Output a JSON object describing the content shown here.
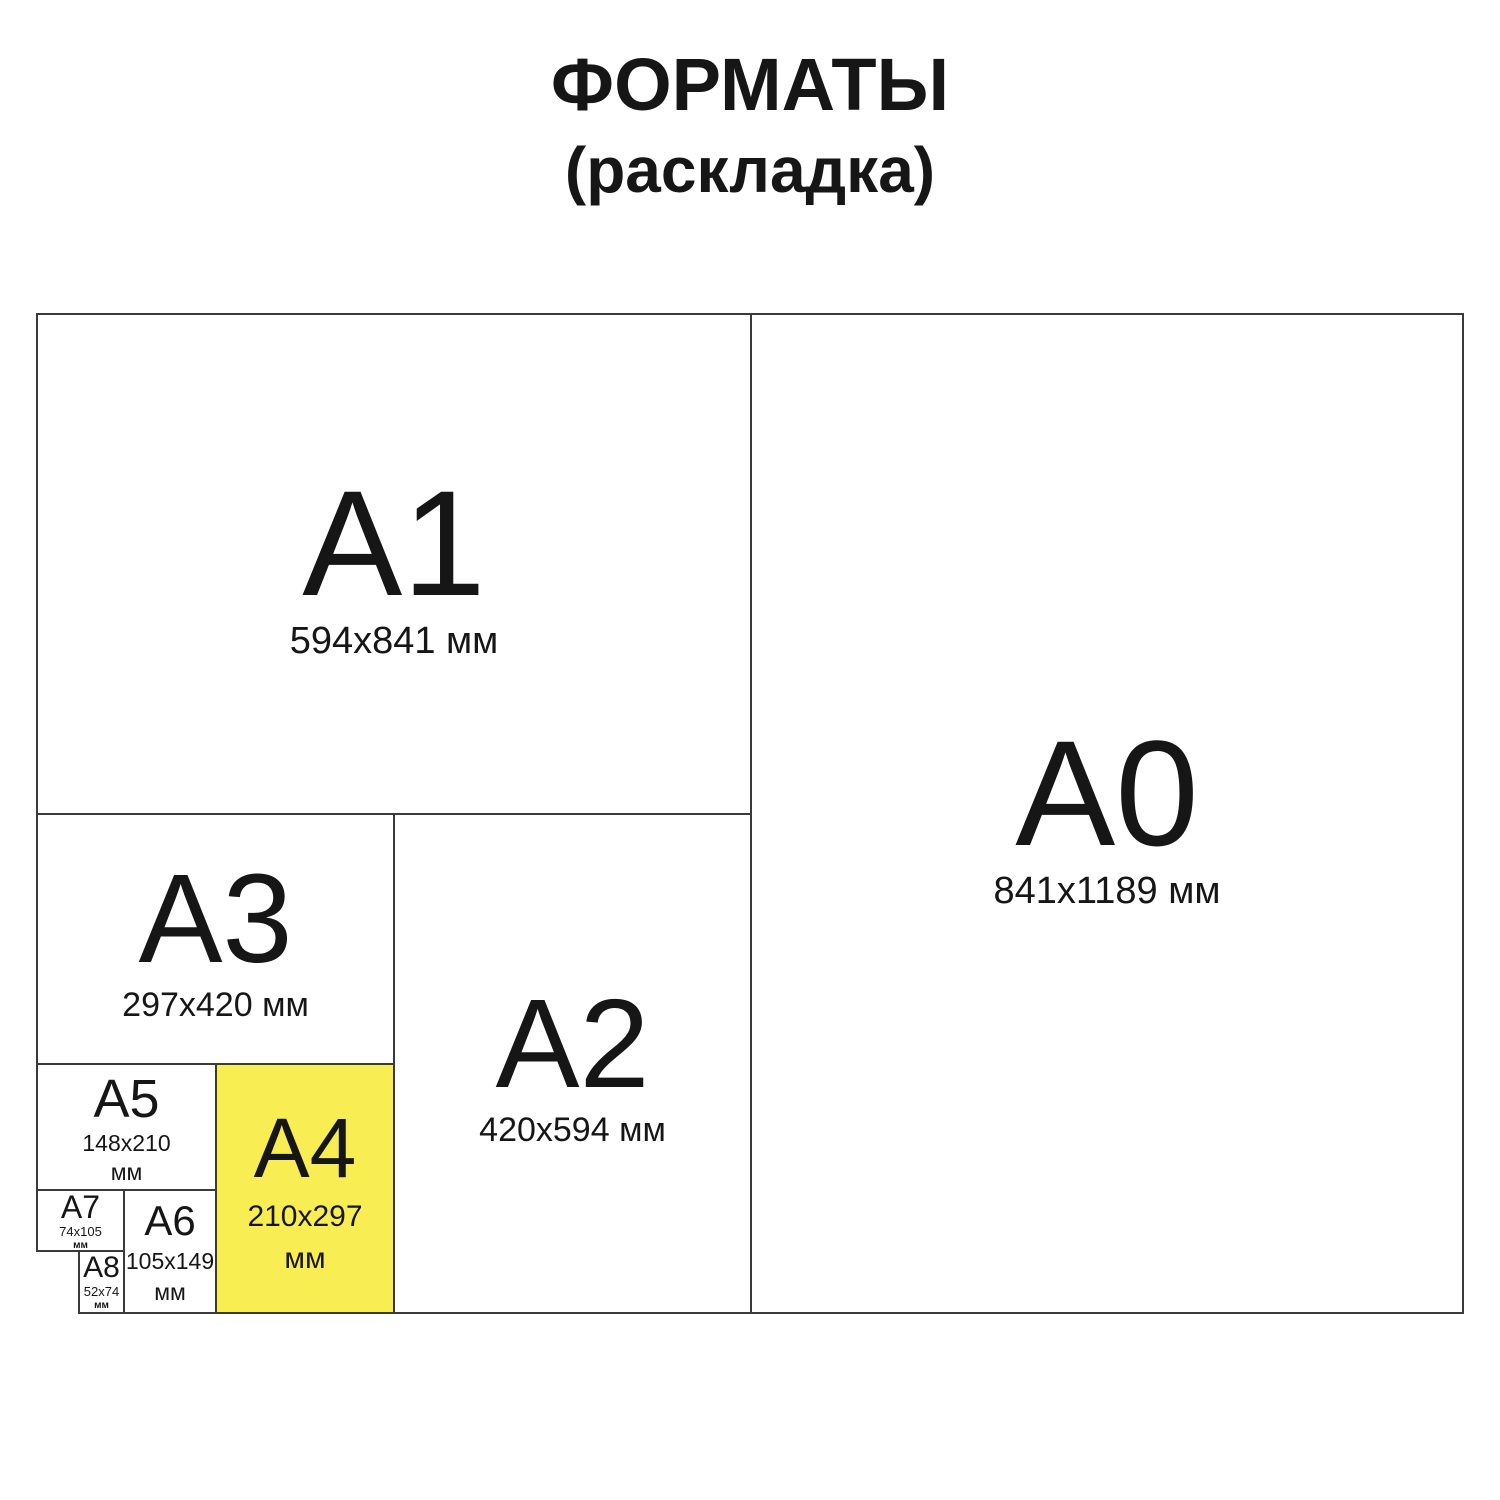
{
  "title": {
    "line1": "ФОРМАТЫ",
    "line2": "(раскладка)"
  },
  "colors": {
    "highlight": "#f8ee54",
    "line": "#3a3a3a",
    "text": "#161616",
    "background": "#ffffff"
  },
  "formats": [
    {
      "id": "A1",
      "label": "A1",
      "dims": "594x841 мм"
    },
    {
      "id": "A0",
      "label": "A0",
      "dims": "841x1189 мм"
    },
    {
      "id": "A3",
      "label": "A3",
      "dims": "297x420 мм"
    },
    {
      "id": "A2",
      "label": "A2",
      "dims": "420x594 мм"
    },
    {
      "id": "A5",
      "label": "A5",
      "dims_line1": "148x210",
      "dims_line2": "мм"
    },
    {
      "id": "A4",
      "label": "A4",
      "dims_line1": "210x297",
      "dims_line2": "мм",
      "highlighted": true
    },
    {
      "id": "A7",
      "label": "A7",
      "dims_line1": "74x105",
      "dims_line2": "мм"
    },
    {
      "id": "A6",
      "label": "A6",
      "dims_line1": "105x149",
      "dims_line2": "мм"
    },
    {
      "id": "A8",
      "label": "A8",
      "dims_line1": "52x74",
      "dims_line2": "мм"
    }
  ]
}
